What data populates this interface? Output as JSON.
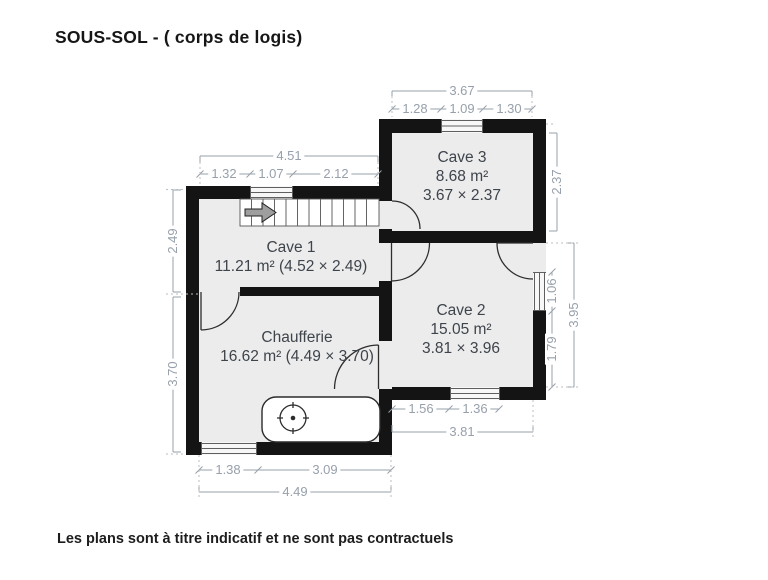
{
  "title": "SOUS-SOL - ( corps de logis)",
  "disclaimer": "Les plans sont à titre indicatif et ne sont pas contractuels",
  "rooms": {
    "cave3": {
      "name": "Cave 3",
      "area": "8.68 m²",
      "size": "3.67 × 2.37"
    },
    "cave1": {
      "name": "Cave 1",
      "details": "11.21 m² (4.52 × 2.49)"
    },
    "chaufferie": {
      "name": "Chaufferie",
      "details": "16.62 m² (4.49 × 3.70)"
    },
    "cave2": {
      "name": "Cave 2",
      "area": "15.05 m²",
      "size": "3.81 × 3.96"
    }
  },
  "dimensions": {
    "cave3_top": {
      "overall": "3.67",
      "seg1": "1.28",
      "seg2": "1.09",
      "seg3": "1.30"
    },
    "cave1_top": {
      "overall": "4.51",
      "seg1": "1.32",
      "seg2": "1.07",
      "seg3": "2.12"
    },
    "left_side": {
      "cave1_height": "2.49",
      "chaufferie_height": "3.70"
    },
    "right_side": {
      "cave3_height": "2.37",
      "window": "1.06",
      "wall": "1.79",
      "overall": "3.95"
    },
    "cave2_bottom": {
      "seg1": "1.56",
      "seg2": "1.36",
      "overall": "3.81"
    },
    "chaufferie_bottom": {
      "seg1": "1.38",
      "seg2": "3.09",
      "overall": "4.49"
    }
  },
  "colors": {
    "wall": "#141414",
    "room_fill": "#ececec",
    "dimension": "#97a0ab",
    "room_text": "#3e444b"
  }
}
